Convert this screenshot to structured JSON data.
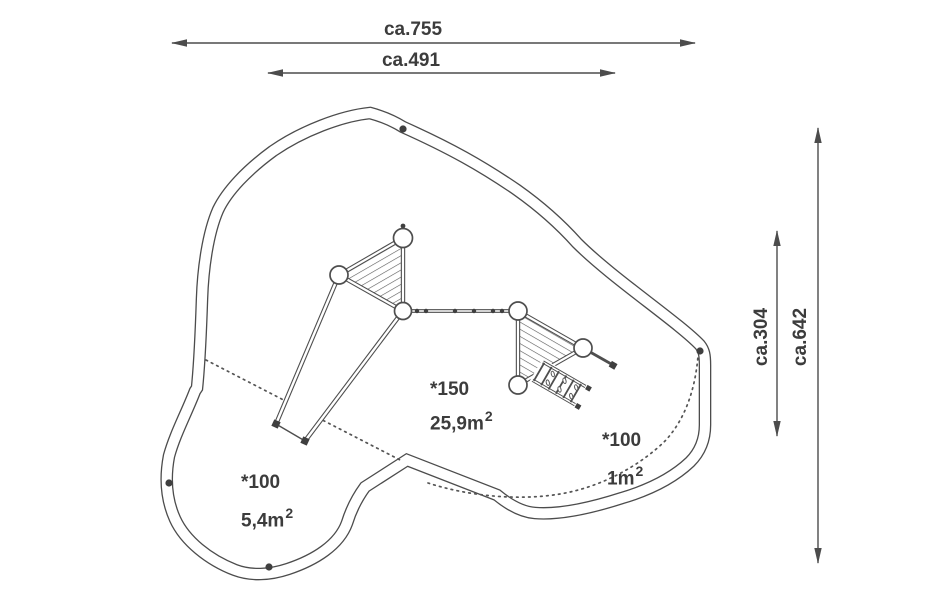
{
  "drawing": {
    "dimensions": {
      "top_outer": "ca.755",
      "top_inner": "ca.491",
      "right_inner": "ca.304",
      "right_outer": "ca.642"
    },
    "areas": {
      "center": {
        "id": "*150",
        "value": "25,9m",
        "sup": "2"
      },
      "right": {
        "id": "*100",
        "value": "1m",
        "sup": "2"
      },
      "bottom_left": {
        "id": "*100",
        "value": "5,4m",
        "sup": "2"
      }
    },
    "colors": {
      "line": "#4c4c4c",
      "text": "#3c3c3c",
      "background": "#ffffff"
    }
  }
}
